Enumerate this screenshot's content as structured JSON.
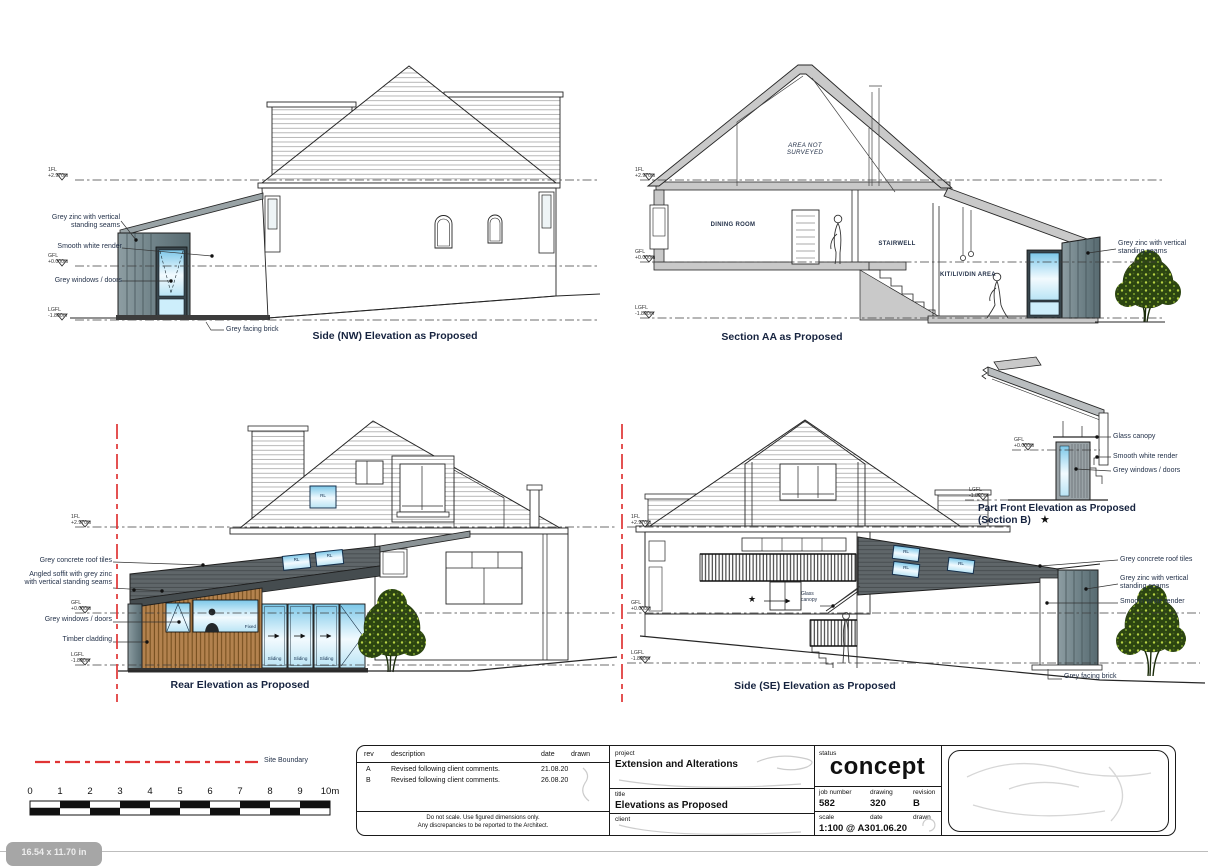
{
  "levels": {
    "fl1": {
      "name": "1FL",
      "value": "+2.970m"
    },
    "gfl": {
      "name": "GFL",
      "value": "+0.000m"
    },
    "lgfl": {
      "name": "LGFL",
      "value": "-1.800m"
    }
  },
  "materials": {
    "zinc": "Grey zinc with vertical standing seams",
    "render": "Smooth white render",
    "windows": "Grey windows / doors",
    "brick": "Grey facing brick",
    "roof_tiles": "Grey concrete roof tiles",
    "soffit": "Angled soffit with grey zinc with vertical standing seams",
    "timber": "Timber cladding",
    "canopy": "Glass canopy"
  },
  "drawings": {
    "nw_title": "Side (NW) Elevation as Proposed",
    "section_title": "Section AA as Proposed",
    "rear_title": "Rear Elevation as Proposed",
    "se_title": "Side (SE) Elevation as Proposed",
    "part_front_title": "Part Front Elevation as Proposed",
    "part_front_subtitle": "(Section B)"
  },
  "rooms": {
    "attic": "AREA NOT SURVEYED",
    "dining": "DINING ROOM",
    "stair": "STAIRWELL",
    "kit": "KIT/LIV/DIN AREA"
  },
  "window_tags": {
    "rl": "RL",
    "fixed": "Fixed",
    "sliding": "Sliding"
  },
  "symbols": {
    "star": "★"
  },
  "legend": {
    "site_boundary": "Site Boundary"
  },
  "scale_bar": {
    "ticks": [
      "0",
      "1",
      "2",
      "3",
      "4",
      "5",
      "6",
      "7",
      "8",
      "9",
      "10m"
    ]
  },
  "title_block": {
    "rev_header": {
      "rev": "rev",
      "description": "description",
      "date": "date",
      "drawn": "drawn"
    },
    "revisions": [
      {
        "rev": "A",
        "description": "Revised following client comments.",
        "date": "21.08.20"
      },
      {
        "rev": "B",
        "description": "Revised following client comments.",
        "date": "26.08.20"
      }
    ],
    "note1": "Do not scale. Use figured dimensions only.",
    "note2": "Any discrepancies to be reported to the Architect.",
    "project_label": "project",
    "project": "Extension and Alterations",
    "title_label": "title",
    "title": "Elevations as Proposed",
    "client_label": "client",
    "status_label": "status",
    "status": "concept",
    "job_label": "job number",
    "job": "582",
    "drawing_label": "drawing",
    "drawing": "320",
    "revision_label": "revision",
    "revision": "B",
    "scale_label": "scale",
    "scale": "1:100 @ A3",
    "date_label": "date",
    "date": "01.06.20",
    "drawn_label": "drawn"
  },
  "badge": "16.54 x 11.70 in",
  "colors": {
    "boundary_red": "#e03434",
    "zinc_grey": "#6d8086",
    "dark_roof": "#5f6669",
    "timber_brown": "#b3824e",
    "glass_blue": "#7cc7e8",
    "annotation_navy": "#24324a"
  }
}
